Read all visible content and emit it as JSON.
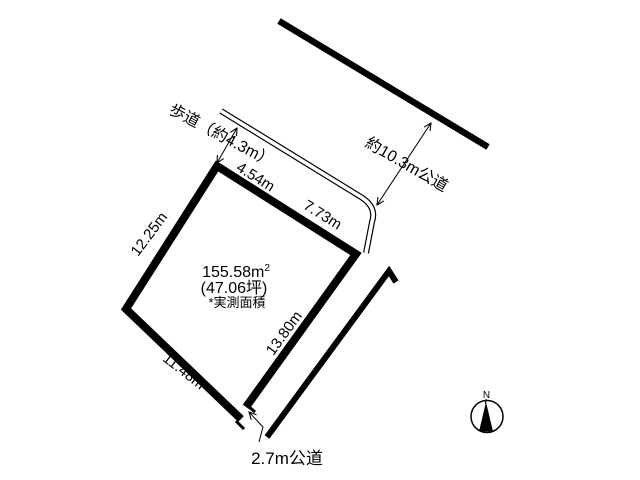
{
  "page": {
    "background": "#ffffff",
    "ink": "#000000"
  },
  "parcel": {
    "area_label": "155.58m",
    "area_superscript": "2",
    "area_tsubo": "(47.06坪)",
    "area_note": "*実測面積",
    "dim_top_left": "4.54m",
    "dim_top_right": "7.73m",
    "dim_left": "12.25m",
    "dim_bottom": "11.48m",
    "dim_right": "13.80m"
  },
  "roads": {
    "sidewalk_label": "歩道（約4.3m）",
    "north_road_label": "約10.3m公道",
    "south_road_label": "2.7m公道"
  },
  "compass": {
    "north_label": "N"
  }
}
